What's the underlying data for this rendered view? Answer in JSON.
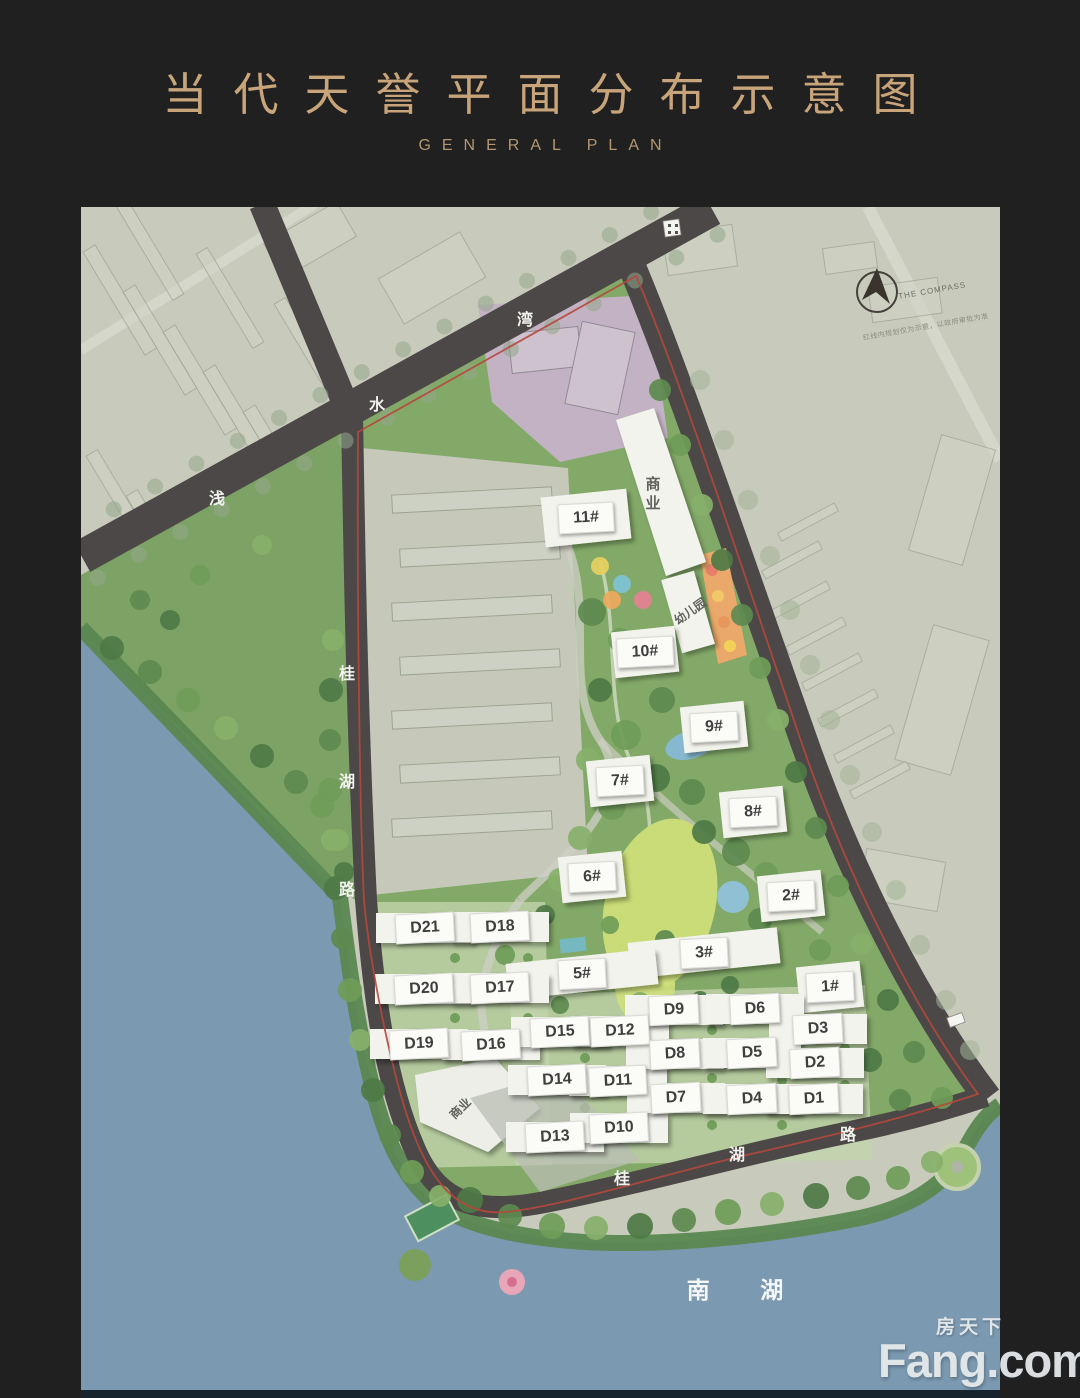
{
  "header": {
    "title": "当代天誉平面分布示意图",
    "subtitle": "GENERAL PLAN"
  },
  "map": {
    "compass": {
      "label": "THE COMPASS",
      "disclaimer": "红线内规划仅为示意，以政府审批为准"
    },
    "lake_label": "南  湖",
    "roads": [
      {
        "name": "浅水湾",
        "chars": [
          {
            "c": "浅",
            "x": 217,
            "y": 497
          },
          {
            "c": "水",
            "x": 377,
            "y": 403
          },
          {
            "c": "湾",
            "x": 525,
            "y": 318
          }
        ]
      },
      {
        "name": "桂湖路",
        "chars": [
          {
            "c": "桂",
            "x": 347,
            "y": 672
          },
          {
            "c": "湖",
            "x": 347,
            "y": 780
          },
          {
            "c": "路",
            "x": 347,
            "y": 888
          }
        ]
      },
      {
        "name": "桂湖路",
        "chars": [
          {
            "c": "桂",
            "x": 622,
            "y": 1177
          },
          {
            "c": "湖",
            "x": 737,
            "y": 1153
          },
          {
            "c": "路",
            "x": 848,
            "y": 1133
          }
        ]
      }
    ],
    "buildings": [
      {
        "label": "11#",
        "x": 586,
        "y": 518,
        "type": "wide11"
      },
      {
        "label": "10#",
        "x": 645,
        "y": 652,
        "type": "tower"
      },
      {
        "label": "9#",
        "x": 714,
        "y": 727,
        "type": "tower"
      },
      {
        "label": "7#",
        "x": 620,
        "y": 781,
        "type": "tower"
      },
      {
        "label": "8#",
        "x": 753,
        "y": 812,
        "type": "tower"
      },
      {
        "label": "6#",
        "x": 592,
        "y": 877,
        "type": "tower"
      },
      {
        "label": "2#",
        "x": 791,
        "y": 896,
        "type": "tower"
      },
      {
        "label": "3#",
        "x": 704,
        "y": 953,
        "type": "wide"
      },
      {
        "label": "5#",
        "x": 582,
        "y": 974,
        "type": "wide"
      },
      {
        "label": "1#",
        "x": 830,
        "y": 987,
        "type": "tower"
      },
      {
        "label": "D21",
        "x": 425,
        "y": 928,
        "type": "slab"
      },
      {
        "label": "D18",
        "x": 500,
        "y": 927,
        "type": "slab"
      },
      {
        "label": "D20",
        "x": 424,
        "y": 989,
        "type": "slab"
      },
      {
        "label": "D17",
        "x": 500,
        "y": 988,
        "type": "slab"
      },
      {
        "label": "D19",
        "x": 419,
        "y": 1044,
        "type": "slab"
      },
      {
        "label": "D16",
        "x": 491,
        "y": 1045,
        "type": "slab"
      },
      {
        "label": "D15",
        "x": 560,
        "y": 1032,
        "type": "slab"
      },
      {
        "label": "D12",
        "x": 620,
        "y": 1031,
        "type": "slab"
      },
      {
        "label": "D14",
        "x": 557,
        "y": 1080,
        "type": "slab"
      },
      {
        "label": "D11",
        "x": 618,
        "y": 1081,
        "type": "slab"
      },
      {
        "label": "D13",
        "x": 555,
        "y": 1137,
        "type": "slab"
      },
      {
        "label": "D10",
        "x": 619,
        "y": 1128,
        "type": "slab"
      },
      {
        "label": "D9",
        "x": 674,
        "y": 1010,
        "type": "slab"
      },
      {
        "label": "D6",
        "x": 755,
        "y": 1009,
        "type": "slab"
      },
      {
        "label": "D3",
        "x": 818,
        "y": 1029,
        "type": "slab"
      },
      {
        "label": "D8",
        "x": 675,
        "y": 1054,
        "type": "slab"
      },
      {
        "label": "D5",
        "x": 752,
        "y": 1053,
        "type": "slab"
      },
      {
        "label": "D2",
        "x": 815,
        "y": 1063,
        "type": "slab"
      },
      {
        "label": "D7",
        "x": 676,
        "y": 1098,
        "type": "slab"
      },
      {
        "label": "D4",
        "x": 752,
        "y": 1099,
        "type": "slab"
      },
      {
        "label": "D1",
        "x": 814,
        "y": 1099,
        "type": "slab"
      }
    ],
    "facilities": [
      {
        "label": "商业",
        "x": 652,
        "y": 495,
        "mode": "vertical"
      },
      {
        "label": "幼儿园",
        "x": 690,
        "y": 611,
        "mode": "rot",
        "deg": -35
      },
      {
        "label": "商业",
        "x": 460,
        "y": 1108,
        "mode": "rot",
        "deg": -44
      }
    ]
  },
  "watermark": {
    "cn": "房天下",
    "en": "Fang.com"
  },
  "colors": {
    "frame": "#212020",
    "gold": "#c8a47a",
    "fabric": "#c8cbbc",
    "road": "#4b4847",
    "water": "#7b99b0",
    "purple": "#c3b2c3",
    "site_green": "#83a968",
    "lawn": "#c9dc77",
    "red_line": "#b5483c",
    "building_white": "#f2f3ec"
  }
}
